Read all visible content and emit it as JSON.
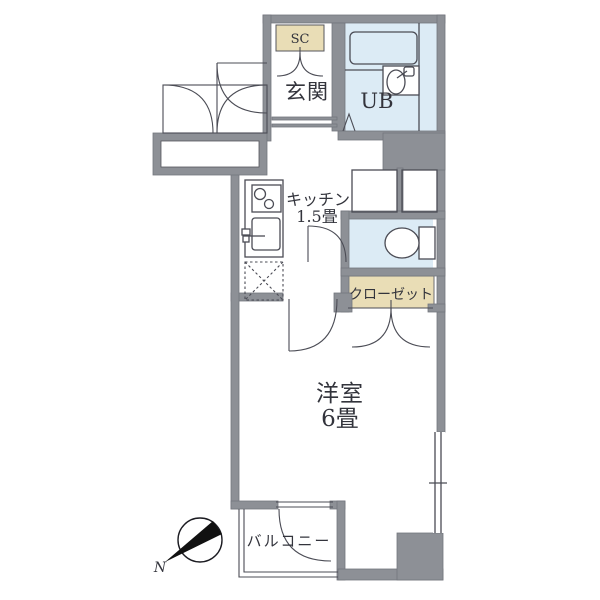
{
  "floor_plan": {
    "rooms": [
      {
        "id": "entrance",
        "label": "玄関"
      },
      {
        "id": "shoe_closet",
        "label": "SC"
      },
      {
        "id": "unit_bath",
        "label": "UB"
      },
      {
        "id": "kitchen",
        "label": "キッチン",
        "size": "1.5畳"
      },
      {
        "id": "closet",
        "label": "クローゼット"
      },
      {
        "id": "western_room",
        "label": "洋室",
        "size": "6畳"
      },
      {
        "id": "balcony",
        "label": "バルコニー"
      }
    ],
    "compass": {
      "north_label": "N"
    }
  },
  "colors": {
    "wall": "#8d9096",
    "wall_edge": "#74767e",
    "wet_area": "#dcebf5",
    "storage_tan": "#e9ddb6",
    "line": "#4b4c55",
    "text": "#33343c",
    "needle": "#111111"
  }
}
